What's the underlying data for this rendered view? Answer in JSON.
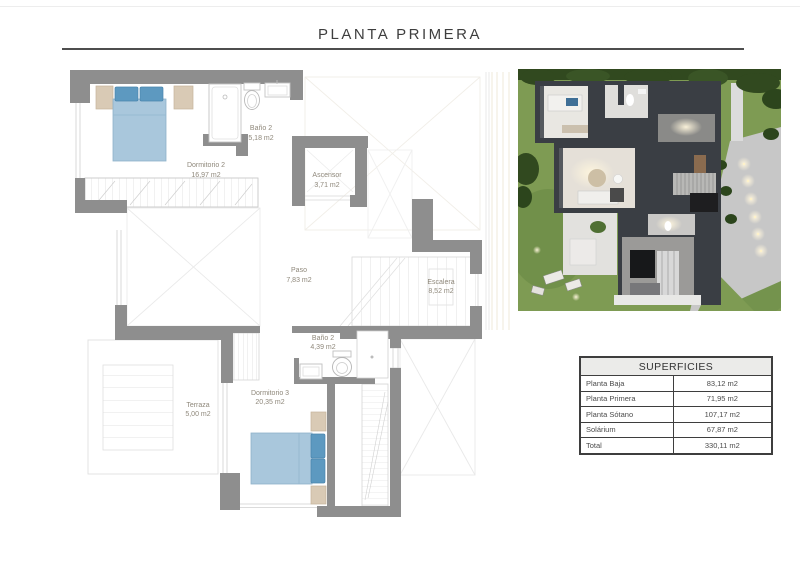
{
  "page": {
    "title": "PLANTA PRIMERA"
  },
  "floor_plan": {
    "rooms": [
      {
        "name": "Dormitorio 2",
        "area": "16,97 m2"
      },
      {
        "name": "Baño 2",
        "area": "5,18 m2"
      },
      {
        "name": "Ascensor",
        "area": "3,71 m2"
      },
      {
        "name": "Paso",
        "area": "7,83 m2"
      },
      {
        "name": "Escalera",
        "area": "8,52 m2"
      },
      {
        "name": "Baño 2",
        "area": "4,39 m2"
      },
      {
        "name": "Dormitorio 3",
        "area": "20,35 m2"
      },
      {
        "name": "Terraza",
        "area": "5,00 m2"
      }
    ]
  },
  "surfaces_table": {
    "title": "SUPERFICIES",
    "rows": [
      {
        "label": "Planta Baja",
        "value": "83,12 m2"
      },
      {
        "label": "Planta Primera",
        "value": "71,95 m2"
      },
      {
        "label": "Planta Sótano",
        "value": "107,17 m2"
      },
      {
        "label": "Solárium",
        "value": "67,87 m2"
      },
      {
        "label": "Total",
        "value": "330,11 m2"
      }
    ]
  },
  "colors": {
    "wall_gray": "#8e8e8e",
    "bed_blue": "#a9c7dc",
    "pillow_blue": "#5d99c0",
    "accent_beige": "#d9cab5",
    "grass_green": "#7e9b53",
    "render_wall_dark": "#3a3e44",
    "title_text": "#3e3e3e",
    "plan_label_text": "#8f887b"
  }
}
